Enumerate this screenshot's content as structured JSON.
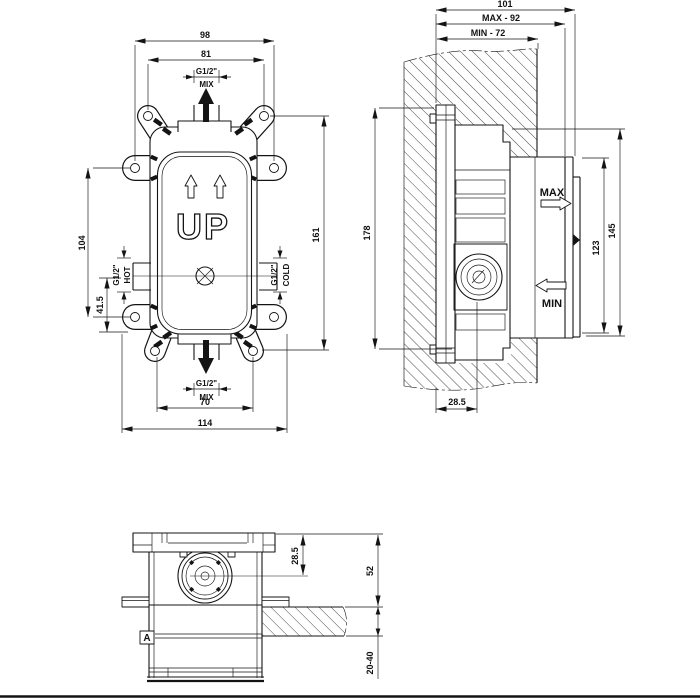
{
  "colors": {
    "line": "#141414",
    "background": "#ffffff"
  },
  "front_view": {
    "dim_tab_span": "98",
    "dim_wing_span": "81",
    "top_port": {
      "size": "G1/2\"",
      "label": "MIX"
    },
    "dim_side_hole_spacing": "104",
    "dim_port_offset": "41.5",
    "left_port": {
      "size": "G1/2\"",
      "label": "HOT"
    },
    "right_port": {
      "size": "G1/2\"",
      "label": "COLD"
    },
    "orientation_label": "UP",
    "dim_wing_height_span": "161",
    "bottom_port": {
      "size": "G1/2\"",
      "label": "MIX"
    },
    "dim_bottom_wing_span": "70",
    "dim_overall_width": "114"
  },
  "side_view": {
    "dim_overall_depth": "101",
    "dim_max_depth": "MAX - 92",
    "dim_min_depth": "MIN - 72",
    "dim_overall_height": "178",
    "max_label": "MAX",
    "min_label": "MIN",
    "dim_collar_height": "123",
    "dim_front_height": "145",
    "dim_valve_axis_depth": "28.5"
  },
  "bottom_view": {
    "dim_valve_axis_depth": "28.5",
    "dim_front_projection": "52",
    "dim_wall_thickness_range": "20-40",
    "section_label": "A"
  }
}
